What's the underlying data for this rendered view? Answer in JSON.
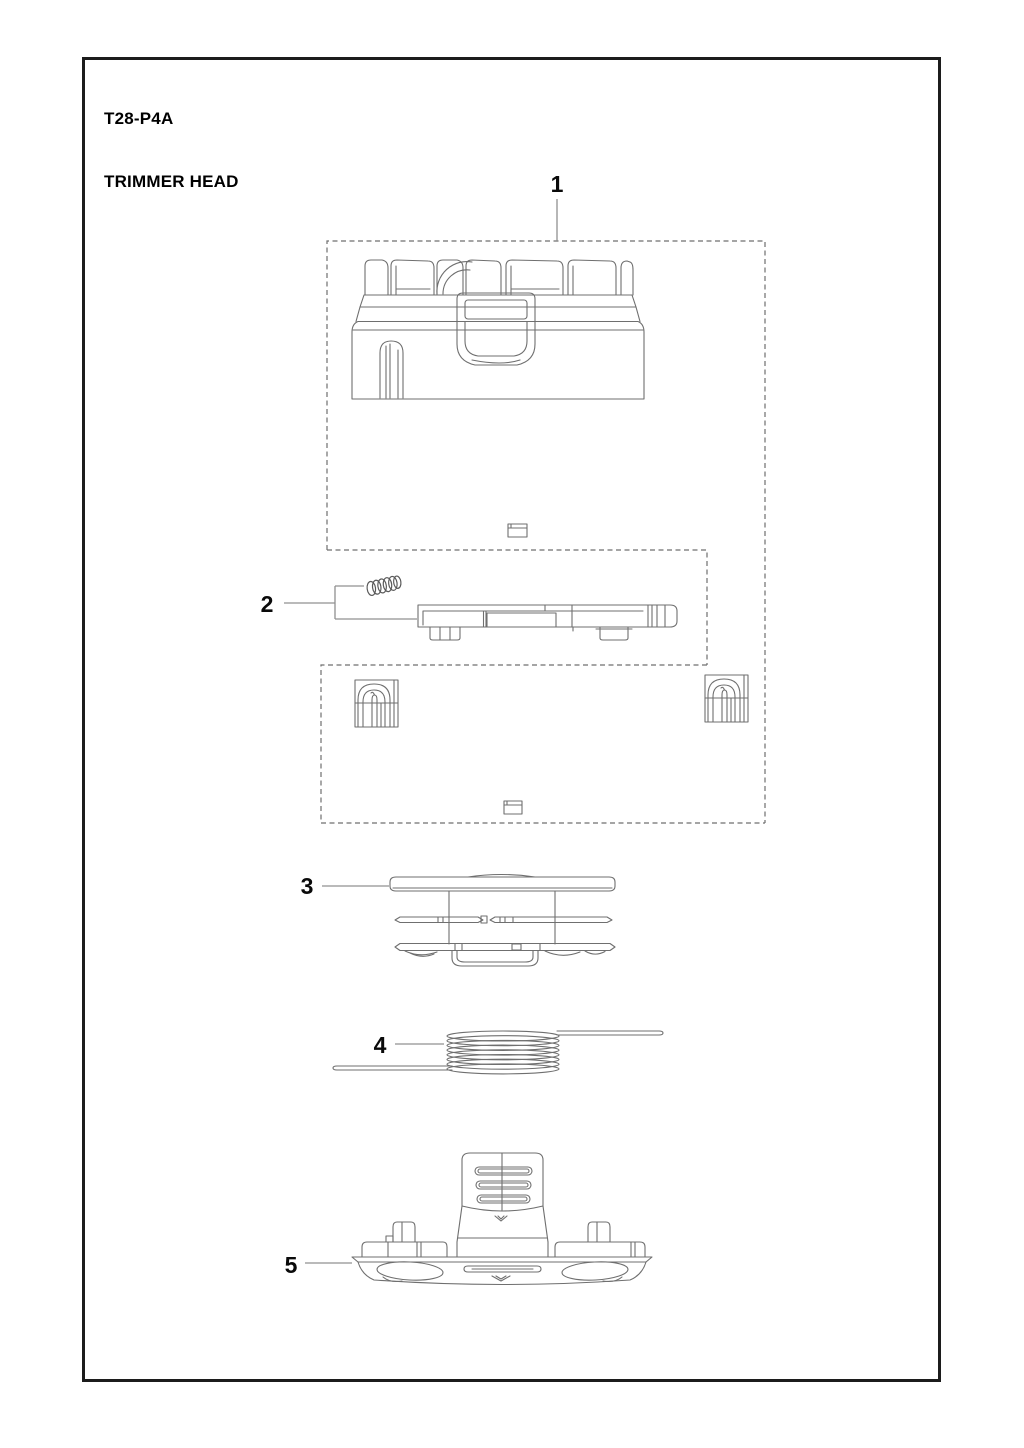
{
  "page": {
    "title": "T28-P4A",
    "subtitle": "TRIMMER HEAD"
  },
  "callouts": {
    "part1": "1",
    "part2": "2",
    "part3": "3",
    "part4": "4",
    "part5": "5"
  },
  "colors": {
    "page_background": "#ffffff",
    "frame_border": "#1c1c1c",
    "drawing_line": "#6f6f6f",
    "dashed_box": "#6f6f6f",
    "callout_text": "#0a0a0a",
    "callout_line": "#909090"
  }
}
